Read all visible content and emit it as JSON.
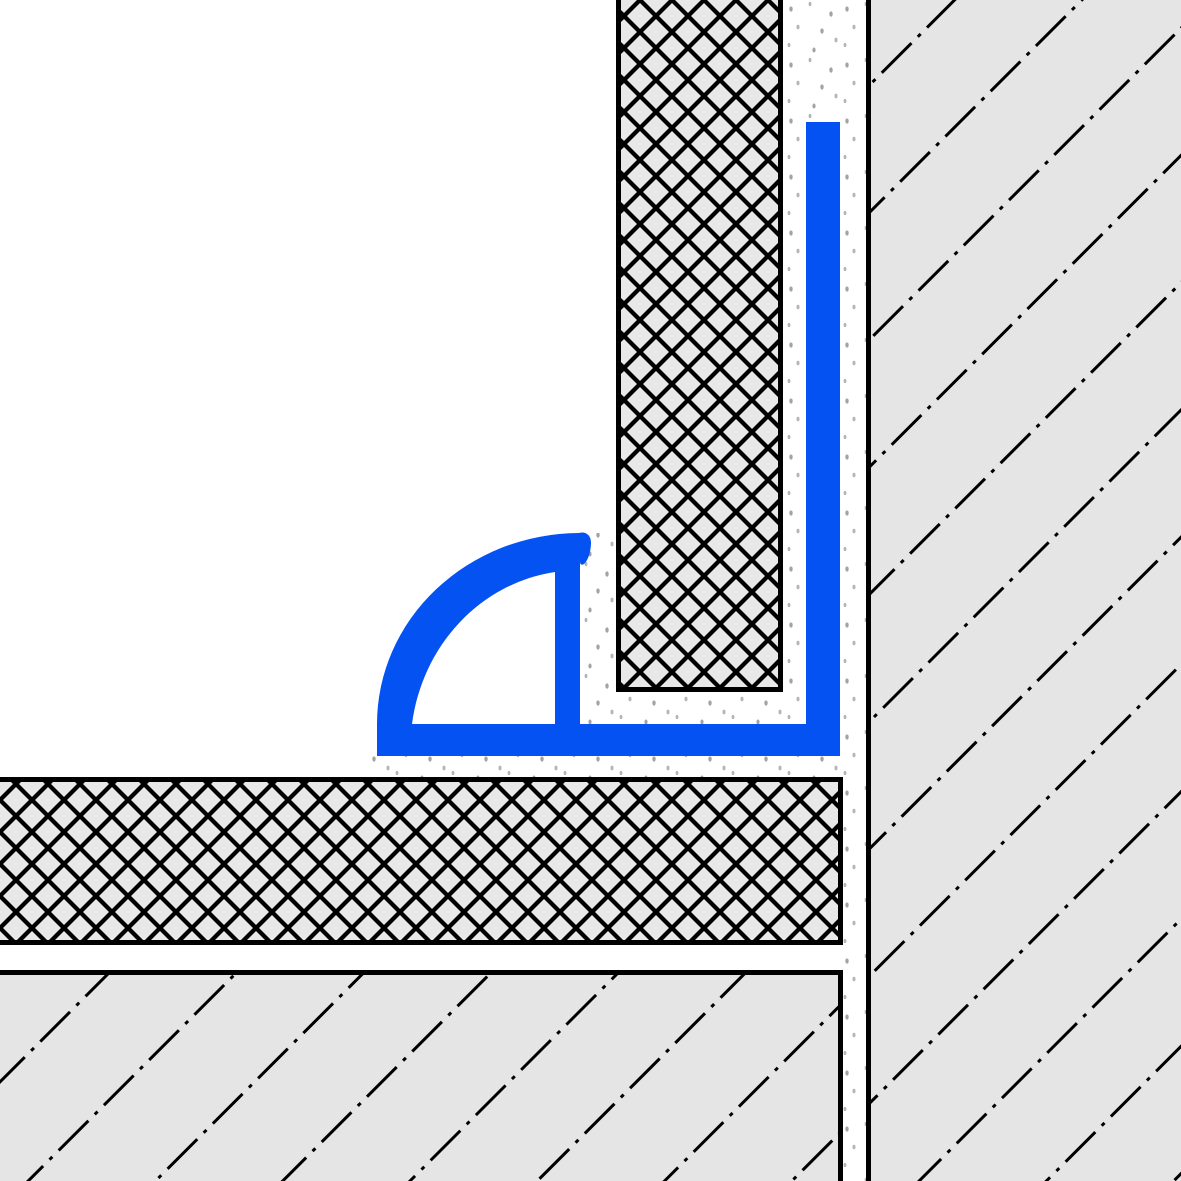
{
  "drawing": {
    "title": "section-detail-quarter-round-tile-edge-profile-at-wall-floor-junction",
    "width": 1181,
    "height": 1181
  },
  "palette": {
    "background_white": "#ffffff",
    "outline_black": "#000000",
    "material_gray": "#e5e5e5",
    "tile_gray": "#e8e8e8",
    "stipple_gray": "#a3a3a3",
    "stipple_gray_light": "#b4b4b4",
    "profile_blue": "#0452f2"
  },
  "patterns": {
    "crosshatch": {
      "tile": 32,
      "stroke_width": 4.3,
      "angle_deg": 45,
      "style": "double-diagonal"
    },
    "dashdot": {
      "tile_w": 64,
      "tile_h": 90,
      "stroke_width": 3,
      "dash": [
        42,
        9,
        4,
        9
      ],
      "angle_deg": -45
    },
    "stipple": {
      "tile": 56,
      "dot_rx": 1.7,
      "dot_ry": 2.6
    }
  },
  "shapes": [
    {
      "name": "background",
      "kind": "rect",
      "x": -2,
      "y": -2,
      "w": 1185,
      "h": 1185,
      "fill": "background_white"
    },
    {
      "name": "adhesive-bed-behind-wall-tile",
      "kind": "rect",
      "x": 783,
      "y": -8,
      "w": 83,
      "h": 732,
      "fill": "stipple"
    },
    {
      "name": "adhesive-joint-gap-at-profile",
      "kind": "rect",
      "x": 580,
      "y": 533,
      "w": 36,
      "h": 191,
      "fill": "stipple"
    },
    {
      "name": "adhesive-under-wall-tile-edge",
      "kind": "rect",
      "x": 616,
      "y": 692,
      "w": 167,
      "h": 32,
      "fill": "stipple"
    },
    {
      "name": "adhesive-under-profile-leg",
      "kind": "rect",
      "x": 372,
      "y": 756,
      "w": 494,
      "h": 21,
      "fill": "stipple"
    },
    {
      "name": "adhesive-column-lower",
      "kind": "rect",
      "x": 840,
      "y": 724,
      "w": 26,
      "h": 465,
      "fill": "stipple"
    },
    {
      "name": "wall-body",
      "kind": "rect",
      "x": 866,
      "y": -8,
      "w": 323,
      "h": 1197,
      "fill": "material_gray"
    },
    {
      "name": "wall-hatch",
      "kind": "rect",
      "x": 866,
      "y": -8,
      "w": 323,
      "h": 1197,
      "fill": "dashdot"
    },
    {
      "name": "wall-border-left",
      "kind": "rect",
      "x": 866,
      "y": -8,
      "w": 5,
      "h": 1197,
      "fill": "outline_black"
    },
    {
      "name": "floor-substrate-body",
      "kind": "rect",
      "x": -8,
      "y": 970,
      "w": 851,
      "h": 219,
      "fill": "material_gray"
    },
    {
      "name": "floor-substrate-hatch",
      "kind": "rect",
      "x": -8,
      "y": 970,
      "w": 851,
      "h": 219,
      "fill": "dashdot"
    },
    {
      "name": "floor-substrate-border-top",
      "kind": "rect",
      "x": -8,
      "y": 970,
      "w": 851,
      "h": 5,
      "fill": "outline_black"
    },
    {
      "name": "floor-substrate-border-right",
      "kind": "rect",
      "x": 838,
      "y": 970,
      "w": 5,
      "h": 219,
      "fill": "outline_black"
    },
    {
      "name": "floor-tile-body",
      "kind": "rect",
      "x": -8,
      "y": 777,
      "w": 851,
      "h": 168,
      "fill": "tile_gray"
    },
    {
      "name": "floor-tile-hatch",
      "kind": "rect",
      "x": -8,
      "y": 777,
      "w": 851,
      "h": 168,
      "fill": "crosshatch"
    },
    {
      "name": "floor-tile-border-top",
      "kind": "rect",
      "x": -8,
      "y": 777,
      "w": 851,
      "h": 5,
      "fill": "outline_black"
    },
    {
      "name": "floor-tile-border-bottom",
      "kind": "rect",
      "x": -8,
      "y": 940,
      "w": 851,
      "h": 5,
      "fill": "outline_black"
    },
    {
      "name": "floor-tile-border-right",
      "kind": "rect",
      "x": 838,
      "y": 777,
      "w": 5,
      "h": 168,
      "fill": "outline_black"
    },
    {
      "name": "wall-tile-body",
      "kind": "rect",
      "x": 616,
      "y": -8,
      "w": 167,
      "h": 700,
      "fill": "tile_gray"
    },
    {
      "name": "wall-tile-hatch",
      "kind": "rect",
      "x": 616,
      "y": -8,
      "w": 167,
      "h": 700,
      "fill": "crosshatch"
    },
    {
      "name": "wall-tile-border-left",
      "kind": "rect",
      "x": 616,
      "y": -8,
      "w": 5,
      "h": 700,
      "fill": "outline_black"
    },
    {
      "name": "wall-tile-border-right",
      "kind": "rect",
      "x": 778,
      "y": -8,
      "w": 5,
      "h": 700,
      "fill": "outline_black"
    },
    {
      "name": "wall-tile-border-bottom",
      "kind": "rect",
      "x": 616,
      "y": 687,
      "w": 167,
      "h": 5,
      "fill": "outline_black"
    },
    {
      "name": "profile-anchor-leg",
      "kind": "path",
      "fill": "profile_blue",
      "d": "M806,122 H840 V756 H377 V724 H806 Z"
    },
    {
      "name": "profile-quarter-round",
      "kind": "path",
      "fill": "profile_blue",
      "fillRule": "evenodd",
      "d": "M377,724 A203,191 0 0 1 579,533 C586,531 591.5,535.5 591,544 C590.5,553 588,560 584.5,563.5 C582.5,565.5 580,565 580,562 L580,724 Z M412,724 A168,178 0 0 1 555,572 L555,724 Z"
    }
  ]
}
